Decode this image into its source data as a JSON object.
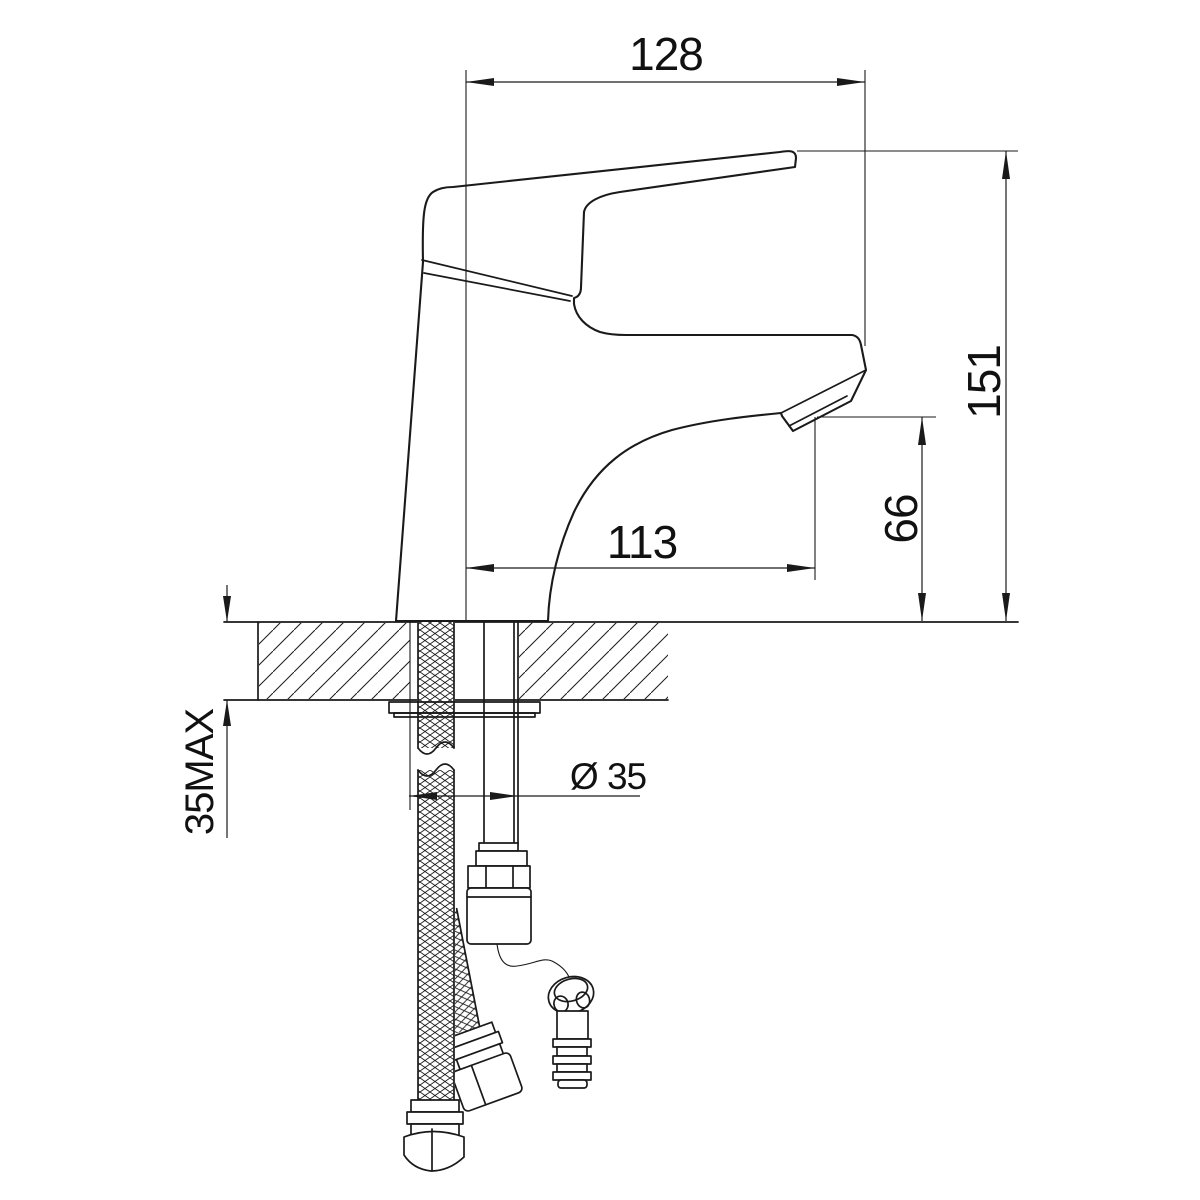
{
  "drawing": {
    "kind": "technical-dimension-drawing",
    "subject": "single-lever basin mixer, side section view with under-counter hoses",
    "colors": {
      "line": "#1a1a1a",
      "background": "#ffffff"
    },
    "dims": {
      "overall_reach": "128",
      "overall_height": "151",
      "spout_reach": "113",
      "spout_height": "66",
      "deck_thickness": "35MAX",
      "hole_diameter": "Ø 35"
    }
  }
}
